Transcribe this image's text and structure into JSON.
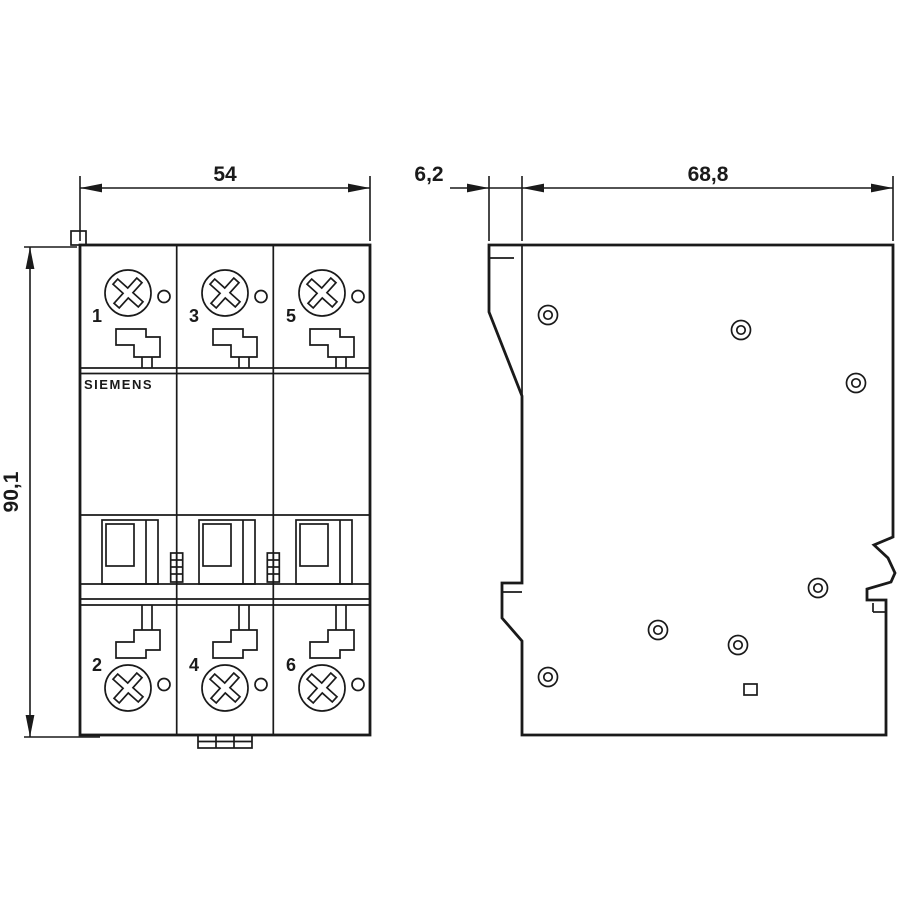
{
  "drawing": {
    "brand_label": "SIEMENS",
    "dimensions": {
      "front_width": "54",
      "front_height": "90,1",
      "side_front_offset": "6,2",
      "side_depth": "68,8"
    },
    "front_view": {
      "top_pole_labels": [
        "1",
        "3",
        "5"
      ],
      "bottom_pole_labels": [
        "2",
        "4",
        "6"
      ]
    },
    "colors": {
      "line": "#1a1a1a",
      "background": "#ffffff"
    }
  }
}
